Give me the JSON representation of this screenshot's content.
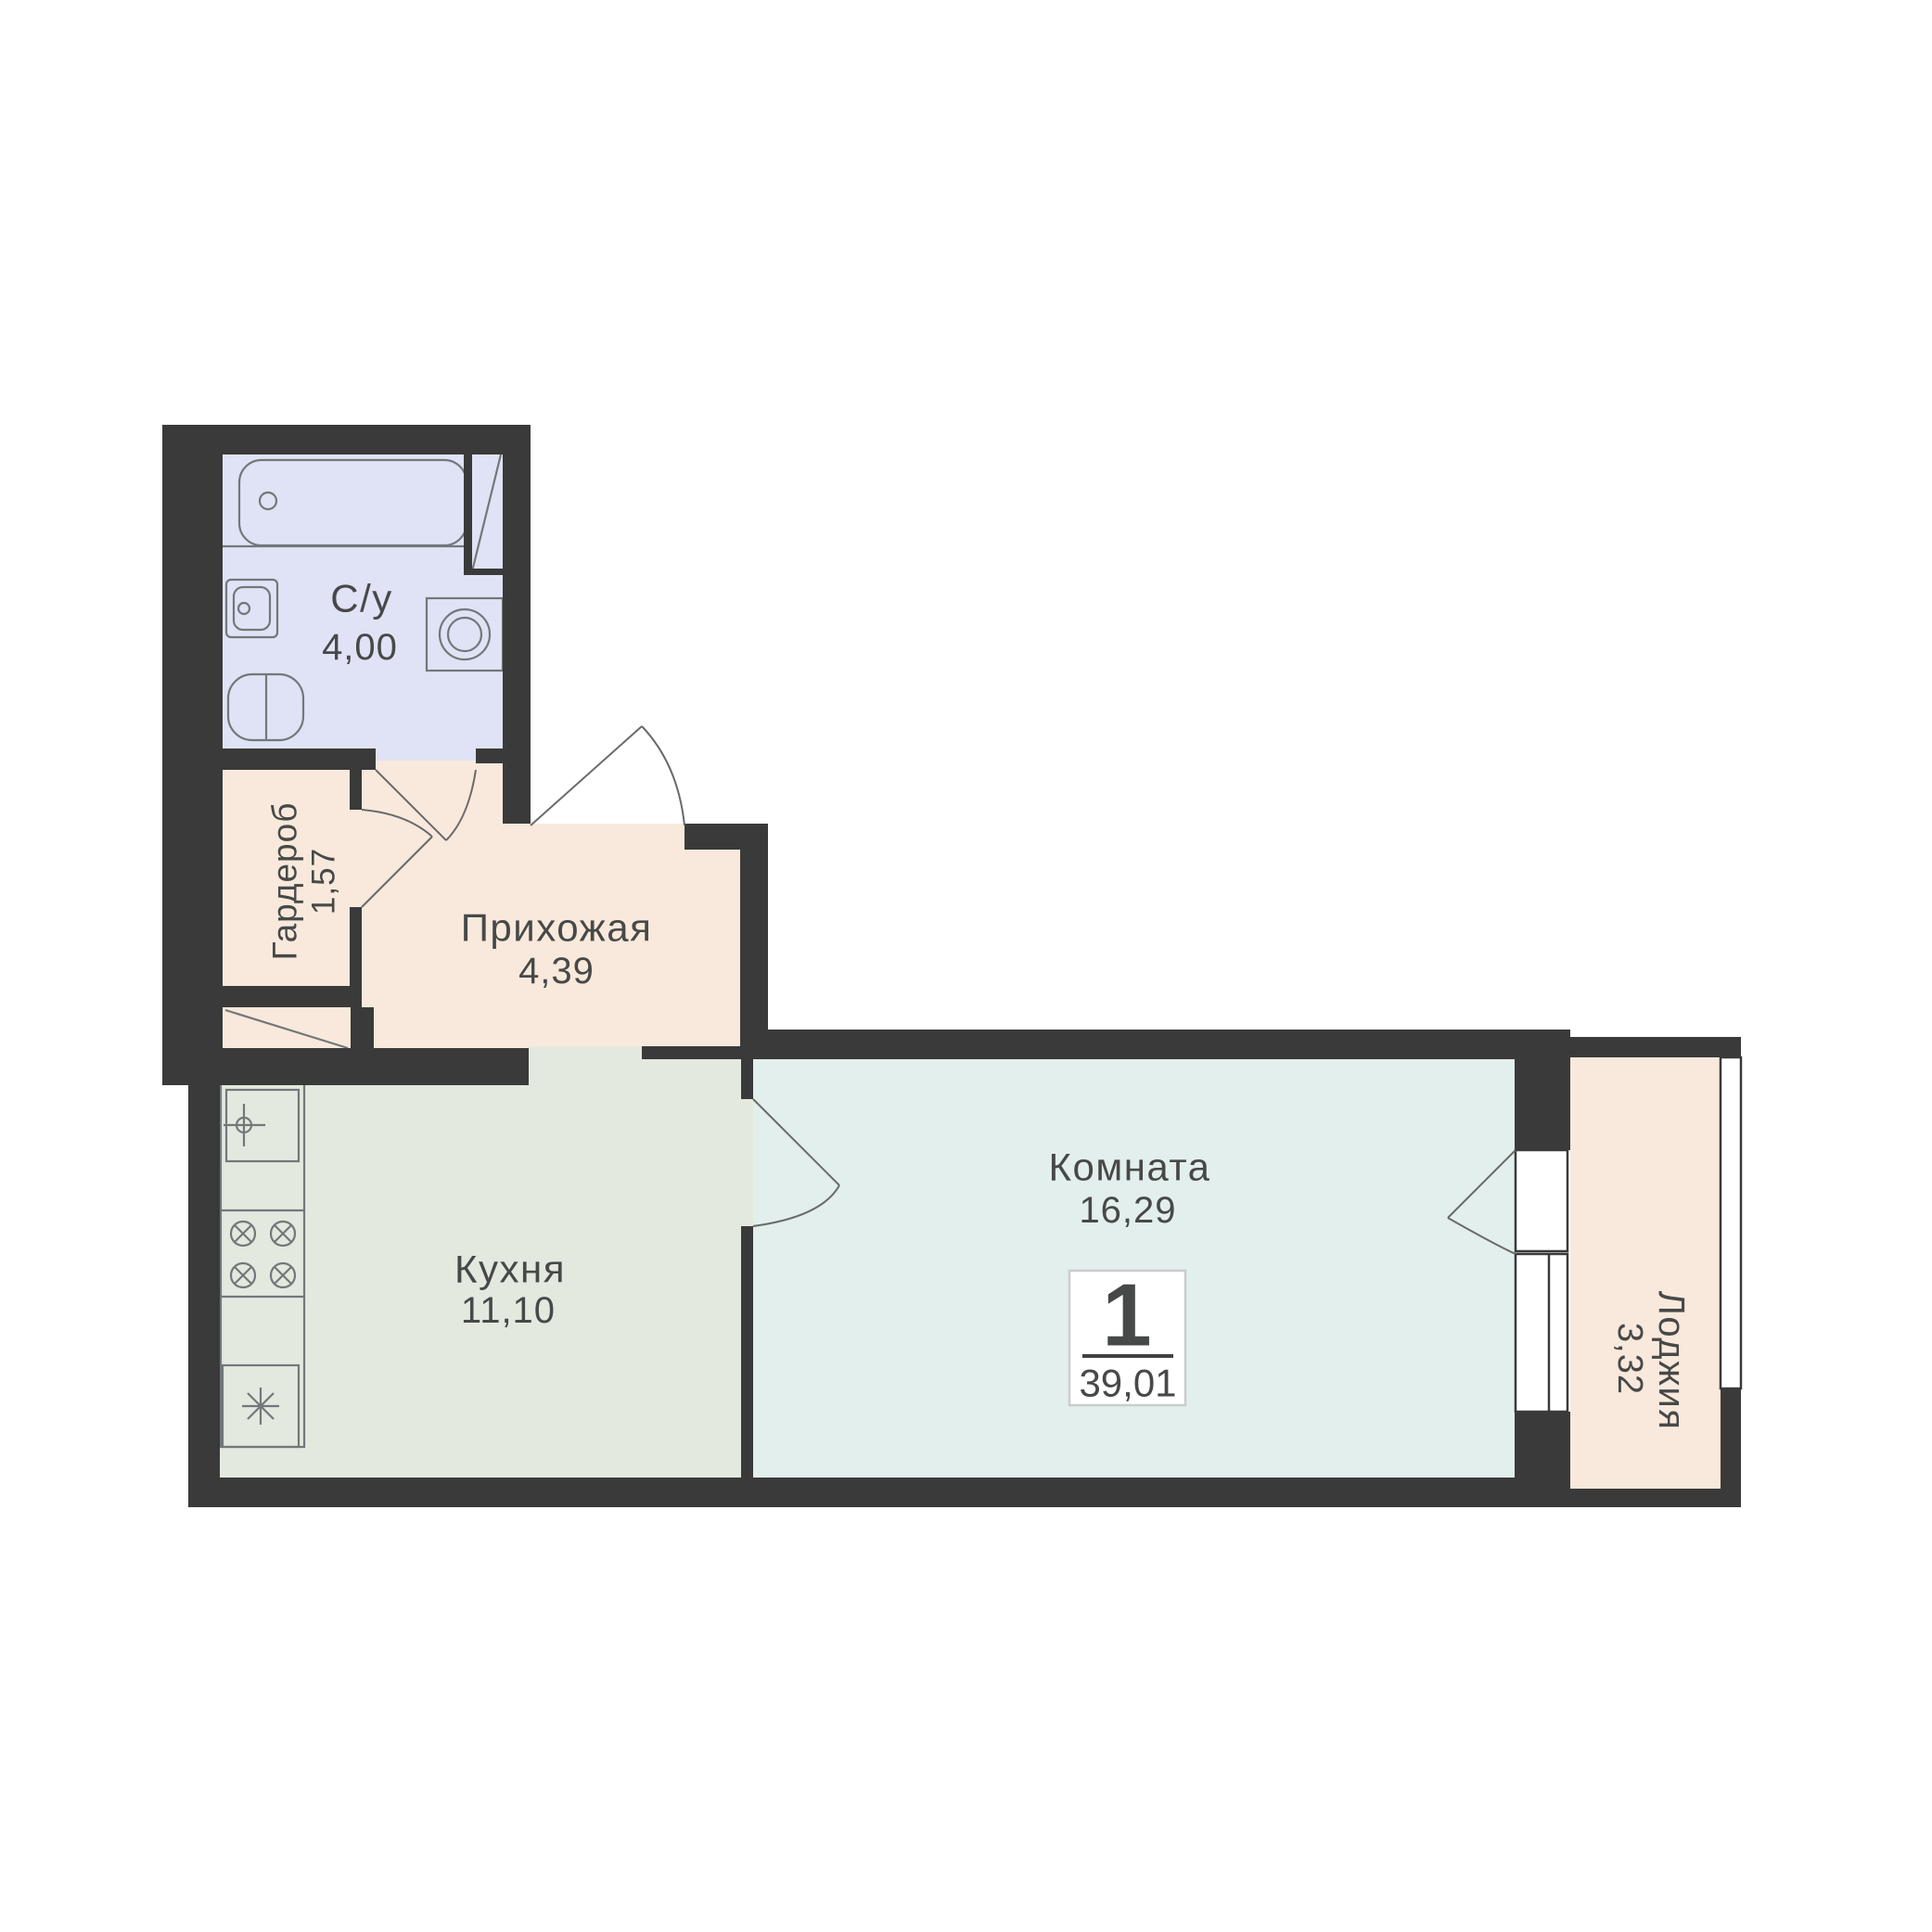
{
  "apartment": {
    "rooms_count": "1",
    "total_area": "39,01"
  },
  "rooms": [
    {
      "id": "bathroom",
      "name": "С/у",
      "area": "4,00"
    },
    {
      "id": "wardrobe",
      "name": "Гардероб",
      "area": "1,57"
    },
    {
      "id": "hallway",
      "name": "Прихожая",
      "area": "4,39"
    },
    {
      "id": "kitchen",
      "name": "Кухня",
      "area": "11,10"
    },
    {
      "id": "living",
      "name": "Комната",
      "area": "16,29"
    },
    {
      "id": "loggia",
      "name": "Лоджия",
      "area": "3,32"
    }
  ],
  "colors": {
    "wall": "#3a3a3a",
    "bathroom_fill": "#dfe3f5",
    "hallway_fill": "#f8e9dc",
    "kitchen_fill": "#e3e9de",
    "living_fill": "#e3efec",
    "loggia_fill": "#f8e9dc",
    "outline": "#72787a",
    "text": "#474948",
    "badge_border": "#c9cdcc"
  },
  "icons": {
    "bathtub": "bathtub-top-view",
    "bathroom_sink": "washbasin",
    "toilet": "toilet-top-view",
    "washing_machine": "washing-machine-drum",
    "vent_shaft": "diagonal-shaft-mark",
    "kitchen_faucet": "faucet-crosshair",
    "stove_burner": "crossed-circle-burner",
    "fridge": "snowflake-asterisk",
    "doors": "quarter-arc-door-swing",
    "windows": "double-line-glazing"
  }
}
